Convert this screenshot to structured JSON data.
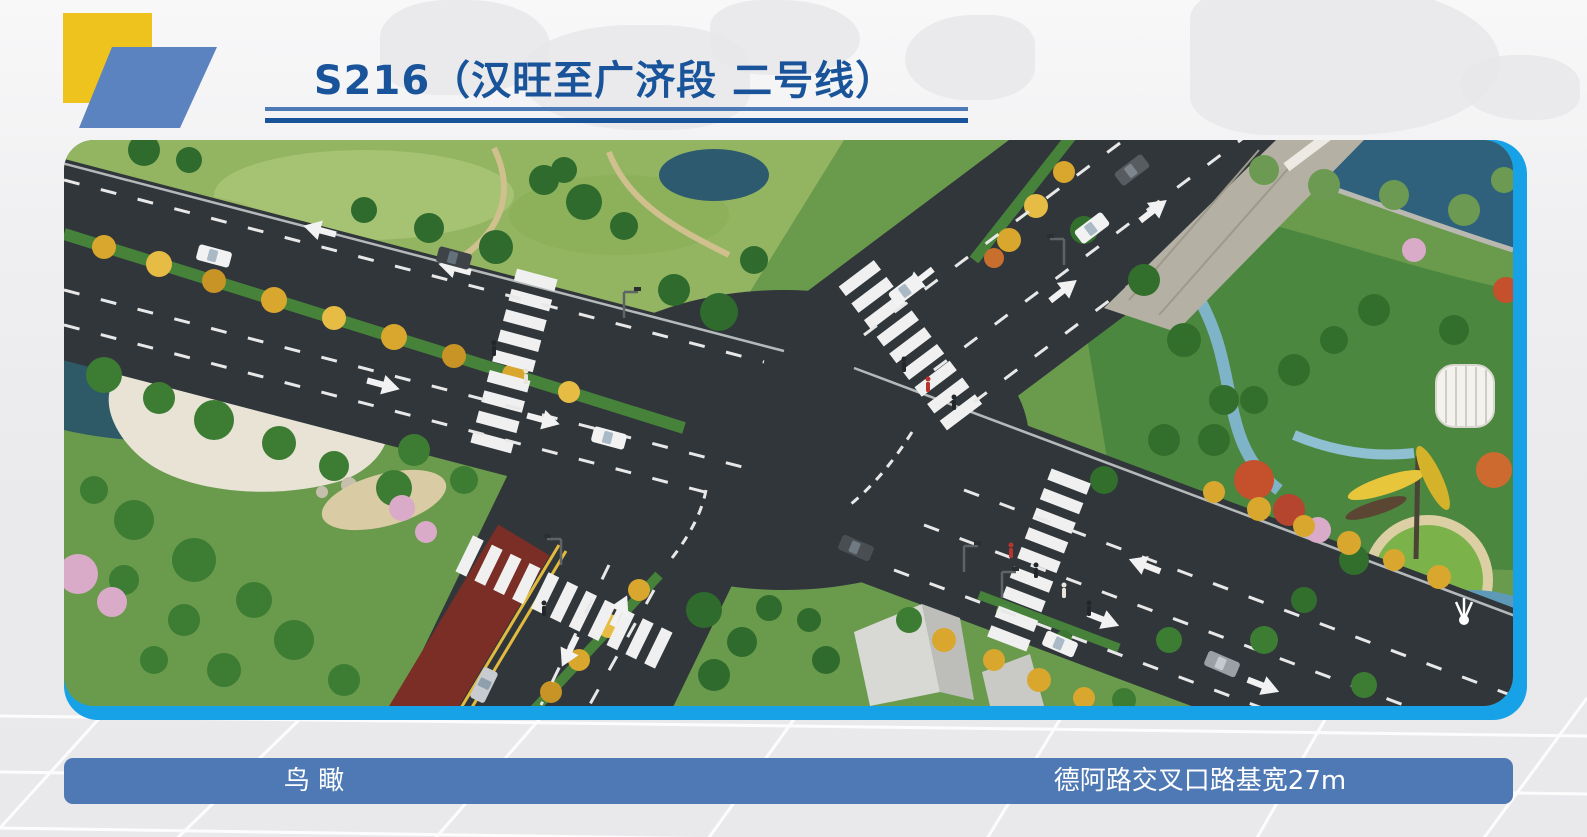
{
  "slide": {
    "title": "S216（汉旺至广济段 二号线）",
    "footer": {
      "left_caption": "鸟  瞰",
      "right_caption": "德阿路交叉口路基宽27m"
    },
    "colors": {
      "title_blue": "#19549b",
      "underline_light_blue": "#4c7ab6",
      "caption_bar_blue": "#4e79b4",
      "figure_border_blue": "#17a2e7",
      "accent_yellow": "#eec31d",
      "parallelogram_blue": "#5b83bf",
      "asphalt": "#30363a",
      "red_bus_lane": "#7b2e25"
    }
  }
}
